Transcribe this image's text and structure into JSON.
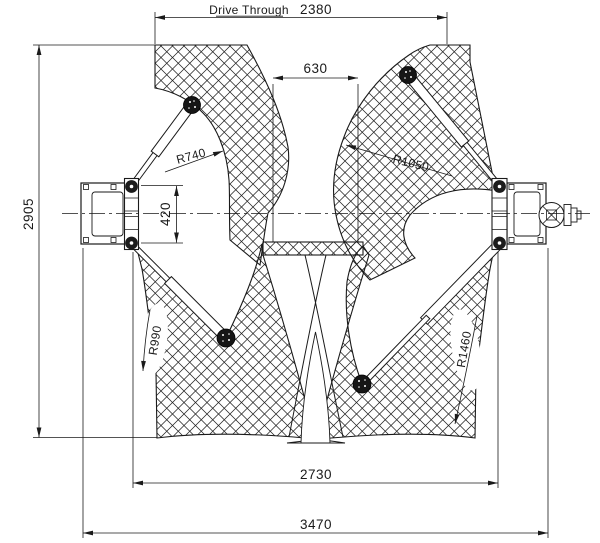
{
  "drawing": {
    "title_dim": {
      "label": "Drive Through",
      "value": "2380"
    },
    "inner_clearance": {
      "value": "630"
    },
    "overall_depth": {
      "value": "2905"
    },
    "carriage_width": {
      "value": "420"
    },
    "post_inner_span": {
      "value": "2730"
    },
    "overall_width": {
      "value": "3470"
    },
    "radii": {
      "front_left": "R740",
      "front_right": "R1050",
      "rear_left": "R990",
      "rear_right": "R1460"
    }
  },
  "colors": {
    "line": "#1a1a1a",
    "background": "#ffffff"
  }
}
